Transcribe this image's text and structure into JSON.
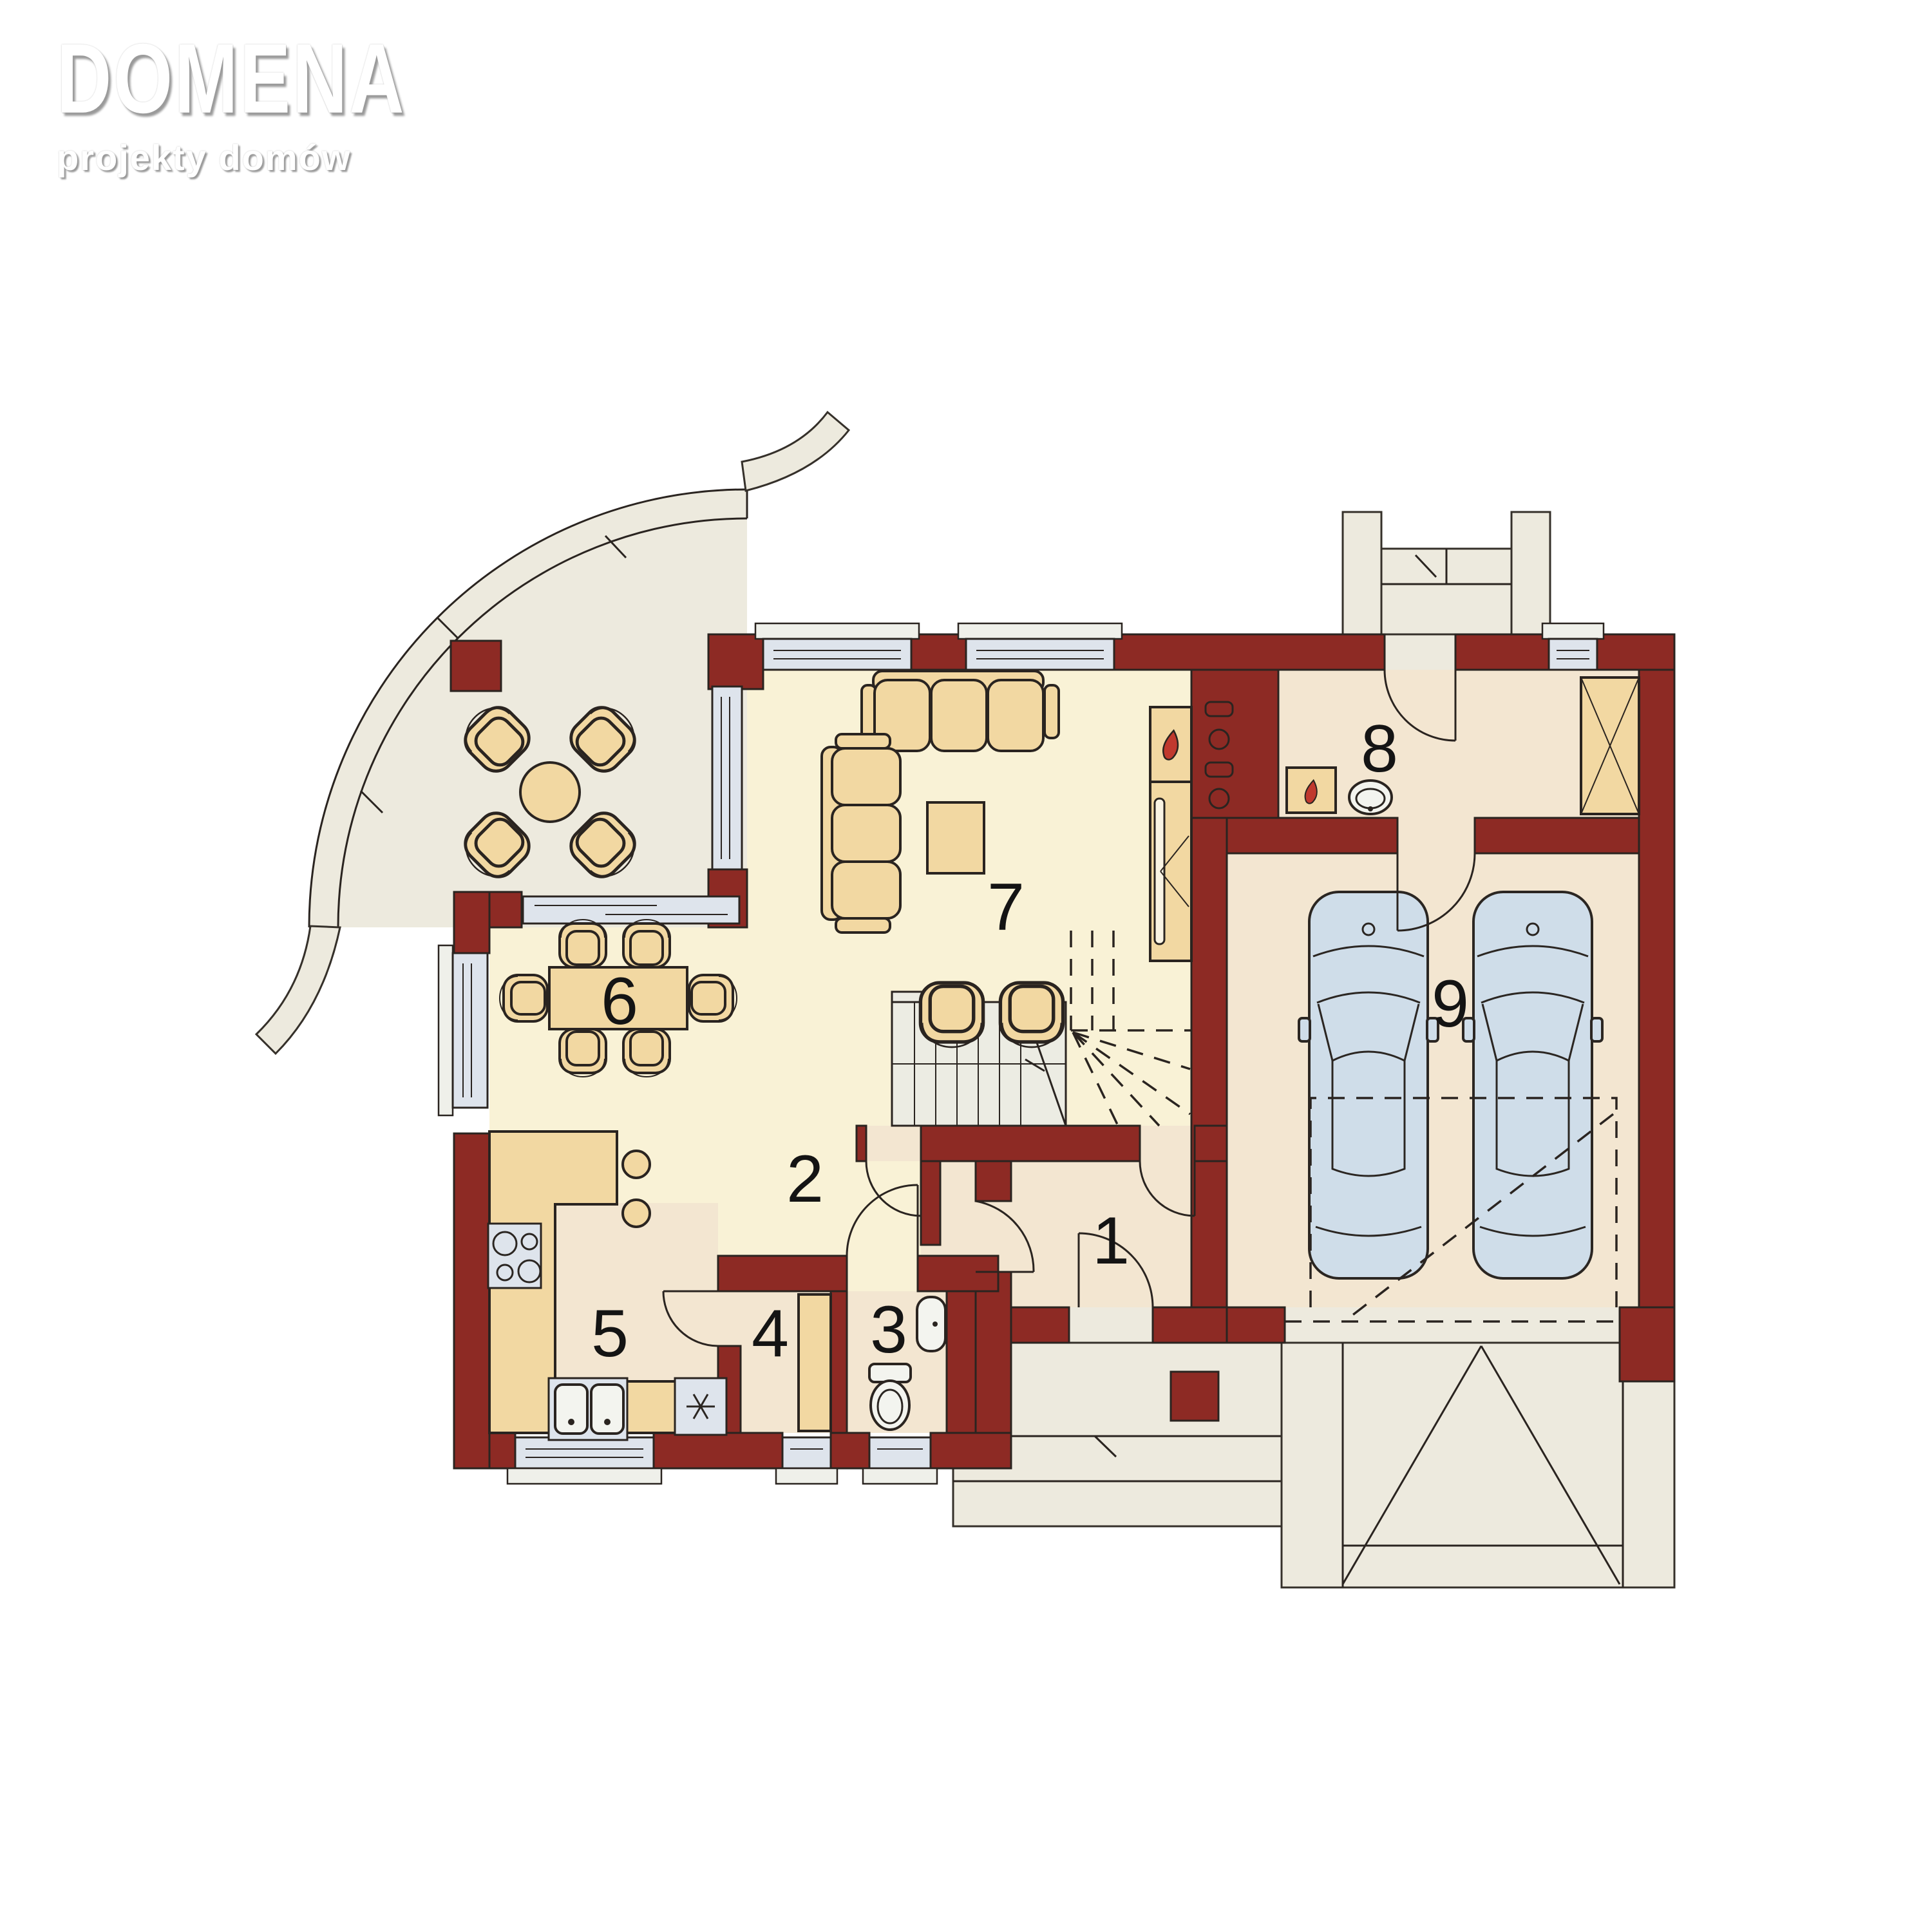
{
  "logo": {
    "title": "DOMENA",
    "subtitle": "projekty domów"
  },
  "rooms": [
    {
      "label": "1"
    },
    {
      "label": "2"
    },
    {
      "label": "3"
    },
    {
      "label": "4"
    },
    {
      "label": "5"
    },
    {
      "label": "6"
    },
    {
      "label": "7"
    },
    {
      "label": "8"
    },
    {
      "label": "9"
    }
  ],
  "colors": {
    "wall": "#8d2a24",
    "floor_main": "#f9f2d6",
    "floor_secondary": "#f3e6d1",
    "outdoor": "#edeade",
    "furniture": "#f2d8a2",
    "glass": "#dee4ec",
    "car": "#cfdde9",
    "flame": "#c0392e"
  }
}
